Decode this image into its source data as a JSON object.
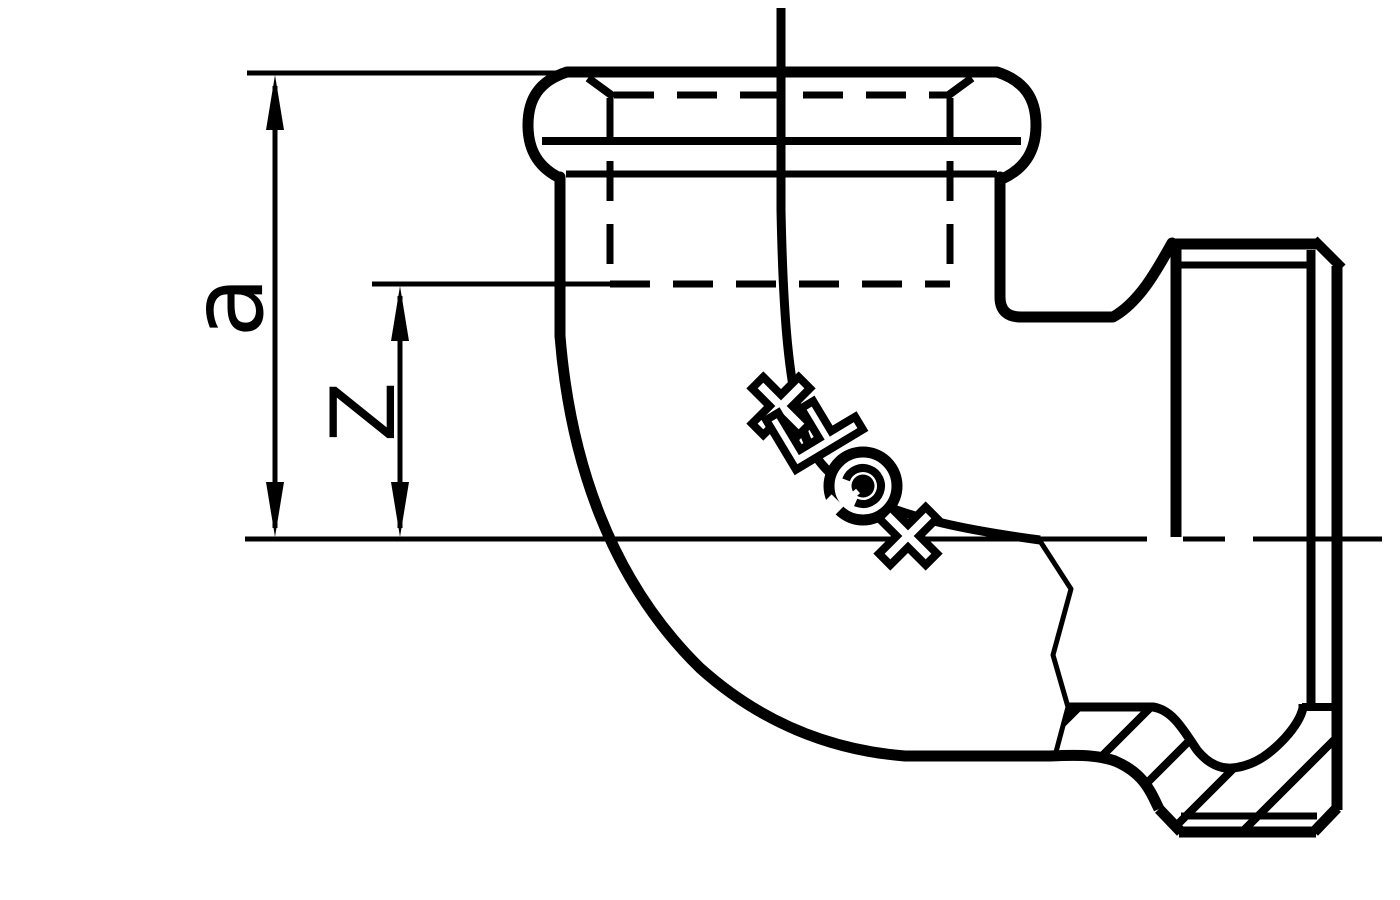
{
  "drawing": {
    "background_color": "#ffffff",
    "line_color": "#000000",
    "dimension_labels": {
      "a": "a",
      "z": "Z"
    },
    "logo_mark": "+GF+"
  }
}
